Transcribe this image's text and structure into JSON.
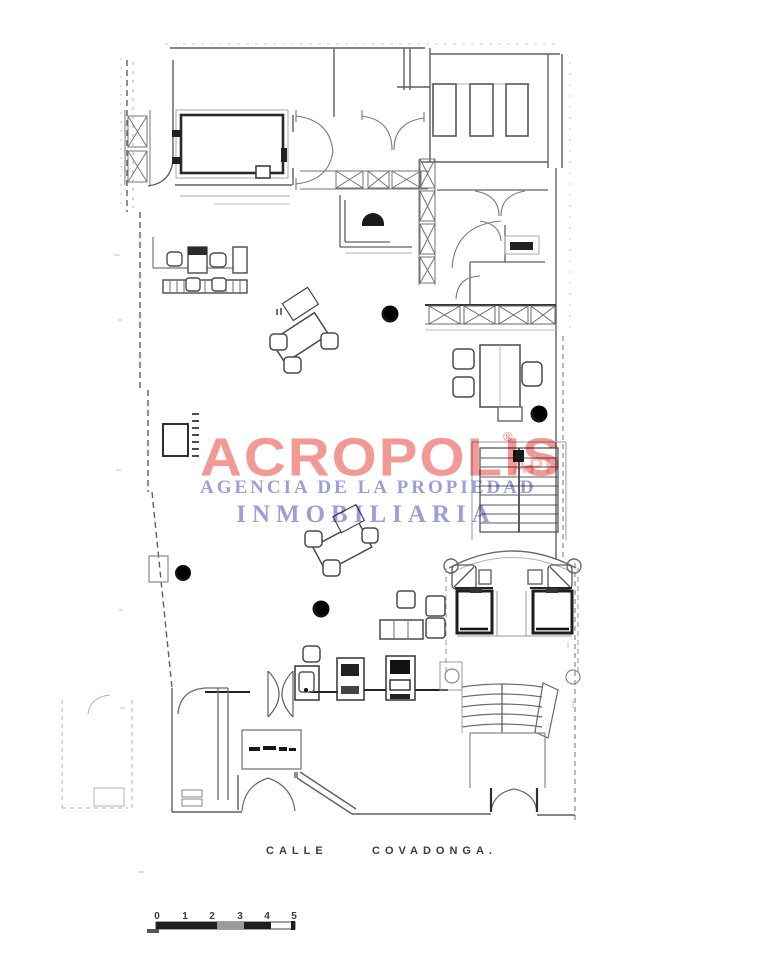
{
  "watermark": {
    "brand": "ACROPOLIS",
    "registered_mark": "®",
    "api_mark": "API",
    "agency_line": "AGENCIA DE LA PROPIEDAD",
    "name_line": "INMOBILIARIA"
  },
  "street": {
    "word1": "CALLE",
    "word2": "COVADONGA."
  },
  "scalebar": {
    "labels": [
      "0",
      "1",
      "2",
      "3",
      "4",
      "5"
    ]
  },
  "colors": {
    "brand": "#f0837d",
    "api": "#f6c3ba",
    "purple": "#8a8ed2",
    "ink": "#3c3c3e"
  }
}
